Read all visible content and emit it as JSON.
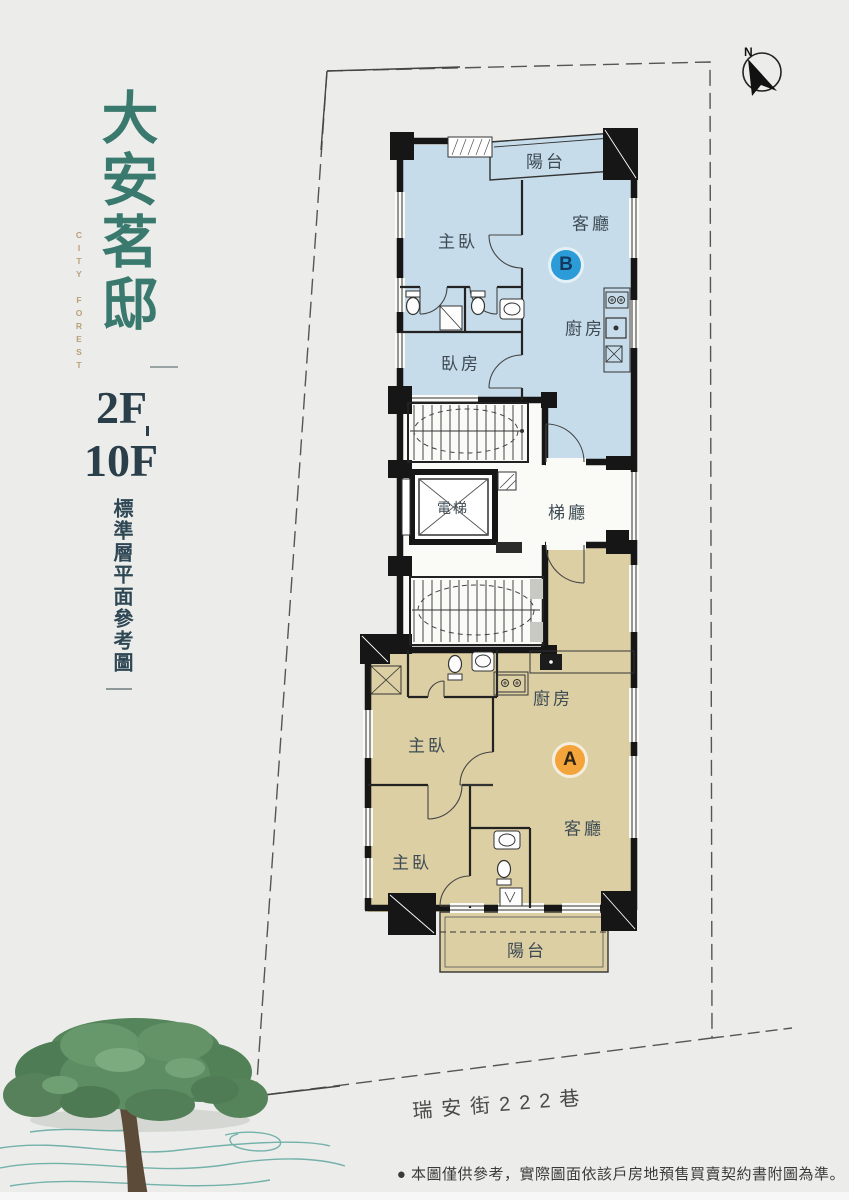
{
  "branding": {
    "title": "大安茗邸",
    "subtitle": "CITY FOREST",
    "floor_from": "2F",
    "floor_to": "10F",
    "caption": "標準層平面參考圖"
  },
  "compass": {
    "label": "N"
  },
  "plan": {
    "unit_b": {
      "badge": "B",
      "labels": {
        "balcony": "陽台",
        "master": "主臥",
        "living": "客廳",
        "kitchen": "廚房",
        "bedroom": "臥房"
      }
    },
    "core": {
      "elevator": "電梯",
      "lobby": "梯廳"
    },
    "unit_a": {
      "badge": "A",
      "labels": {
        "kitchen": "廚房",
        "master1": "主臥",
        "living": "客廳",
        "master2": "主臥",
        "balcony": "陽台"
      }
    }
  },
  "street": {
    "name": "瑞安街222巷"
  },
  "footer": {
    "disclaimer": "● 本圖僅供參考，實際圖面依該戶房地預售買賣契約書附圖為準。"
  },
  "colors": {
    "background": "#ECEDEA",
    "accent_green": "#3A7A6E",
    "accent_gold": "#B9A078",
    "dark_slate": "#2B3F4A",
    "unit_b_fill": "#C7DCEA",
    "unit_a_fill": "#DCCFA3",
    "badge_b": "#2B9CD8",
    "badge_a": "#F3A43B",
    "wall": "#161616",
    "swirl_teal": "#5FA79F"
  }
}
